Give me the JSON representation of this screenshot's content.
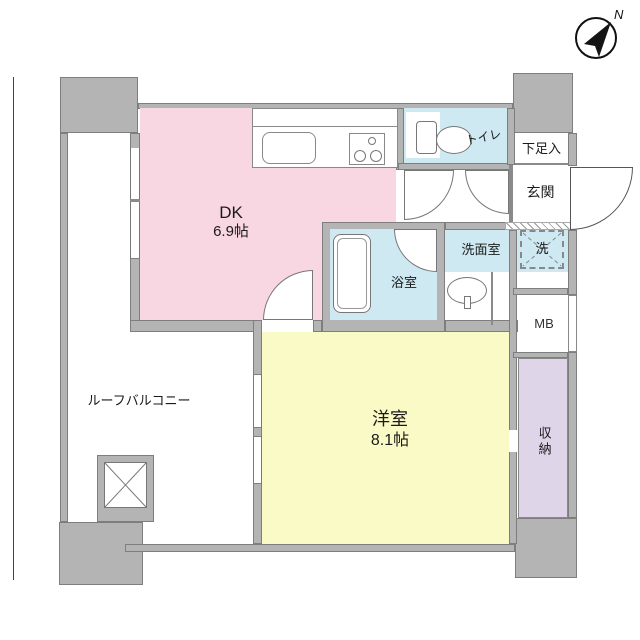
{
  "title": "間取り図",
  "compass": {
    "north_label": "N"
  },
  "rooms": {
    "dk": {
      "name": "DK",
      "size": "6.9帖"
    },
    "bedroom": {
      "name": "洋室",
      "size": "8.1帖"
    },
    "toilet": {
      "name": "トイレ"
    },
    "shoe_box": {
      "name": "下足入"
    },
    "entrance": {
      "name": "玄関"
    },
    "washroom": {
      "name": "洗面室"
    },
    "washer": {
      "name": "洗"
    },
    "bathroom": {
      "name": "浴室"
    },
    "meter_box": {
      "name": "MB"
    },
    "storage": {
      "name": "収納"
    },
    "roof_balcony": {
      "name": "ルーフバルコニー"
    }
  },
  "colors": {
    "wall": "#b4b4b4",
    "wall_edge": "#7e7e7e",
    "dk": "#f8d7e2",
    "bedroom": "#fafac6",
    "wet": "#cfe9f2",
    "storage": "#ded5e9",
    "line": "#8a8a8a"
  }
}
